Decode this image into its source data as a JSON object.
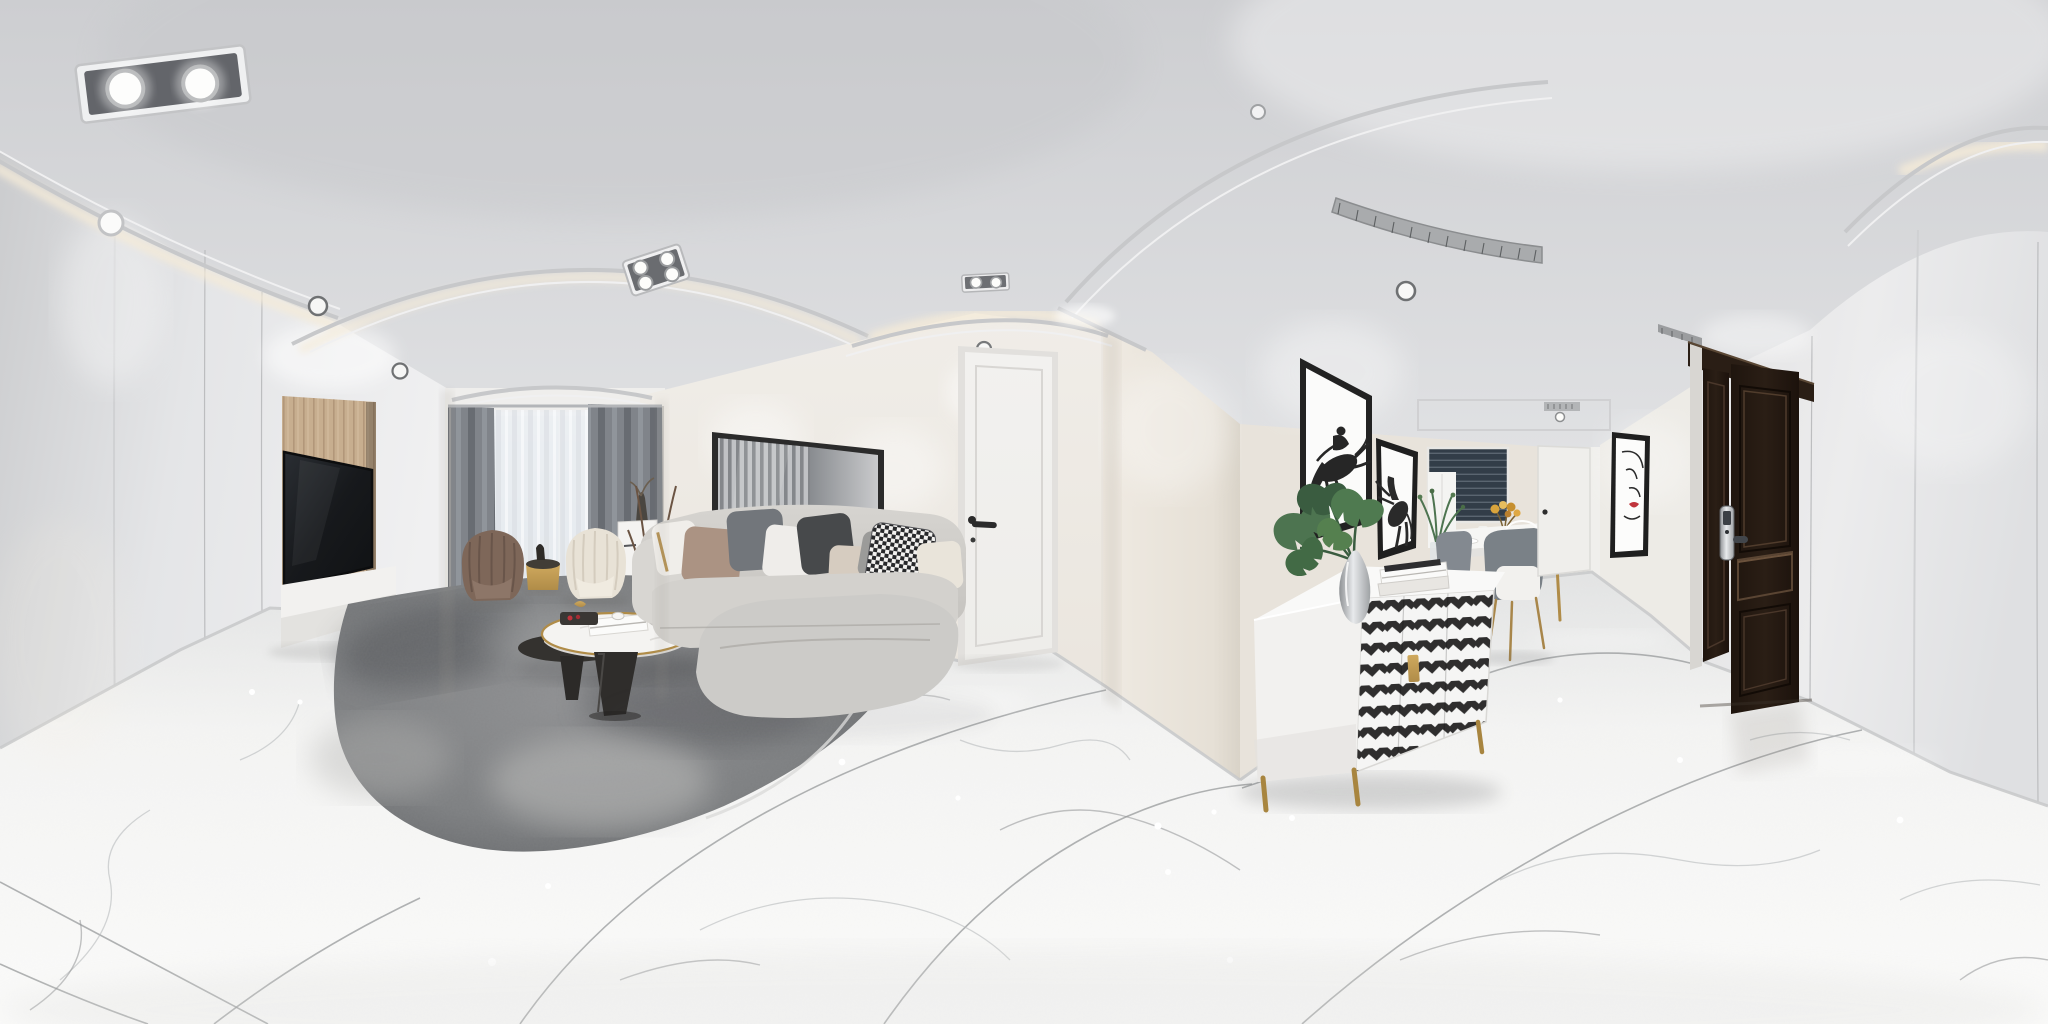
{
  "meta": {
    "kind": "photograph",
    "projection": "equirectangular-360-panorama",
    "subject": "modern minimalist white apartment interior: living room, entry hallway and dining nook",
    "width_px": 2048,
    "height_px": 1024,
    "no_visible_text": true
  },
  "palette": {
    "ceiling_top": "#cdced1",
    "ceiling_bottom": "#e2e3e5",
    "led_warm": "#f5ebd8",
    "wall_white": "#eceae7",
    "wall_bright": "#f2f1ee",
    "wall_warm": "#e9e4dc",
    "wall_left_light": "#e4e5e7",
    "wall_left_dark": "#cbccce",
    "floor_light": "#f4f4f3",
    "floor_shade": "#e3e4e4",
    "rug_dark": "#5d5f62",
    "rug_mid": "#8f9092",
    "sofa_light": "#d6d4d0",
    "sofa_mid": "#c5c3bf",
    "sofa_dark": "#a5a29d",
    "pillow_taupe": "#ab9383",
    "pillow_charcoal": "#47494b",
    "pillow_velvet": "#72767b",
    "pillow_beige": "#d6ccc0",
    "pillow_white": "#f0eeea",
    "curtain_gray": "#80848a",
    "sheer_white": "#edeff1",
    "window_sky": "#e6eef5",
    "tv_wood": "#c7ae8f",
    "tv_screen": "#17191c",
    "interior_door": "#eeedea",
    "entry_door": "#2a1e15",
    "gold_accent": "#b08c48",
    "chevron_dark": "#2f2e2e",
    "art_black": "#222222",
    "art_red": "#c0343c",
    "plant_green": "#4d7450",
    "plant_green_dark": "#3a5c40",
    "chair_brown": "#7e6759",
    "chair_cream": "#e8e2d6",
    "dining_chair_gray": "#7a8187",
    "blinds_dark": "#323d48"
  },
  "scene": {
    "ceiling": {
      "objects": [
        {
          "id": "twin-spot-fixture-left",
          "label": "recessed twin square spotlight, top left"
        },
        {
          "id": "quad-spot-fixture",
          "label": "recessed 4-lamp grille spotlight over living room"
        },
        {
          "id": "twin-spot-fixture-door",
          "label": "small twin spotlight above interior door"
        },
        {
          "id": "cove-led-arcs",
          "label": "curved plaster coves with warm LED strips"
        },
        {
          "id": "ac-vent",
          "label": "linear air-conditioning grille, hallway ceiling"
        },
        {
          "id": "downlights",
          "label": "round recessed downlights"
        }
      ]
    },
    "living_room": {
      "objects": [
        {
          "id": "tv",
          "label": "wall-mounted flat TV on light wood feature panel"
        },
        {
          "id": "tv-console",
          "label": "white floating media console"
        },
        {
          "id": "window",
          "label": "bay window, gray blackout curtains and white sheers"
        },
        {
          "id": "armchair-brown",
          "label": "brown channel-tufted shell armchair"
        },
        {
          "id": "armchair-cream",
          "label": "cream channel-tufted shell armchair"
        },
        {
          "id": "side-table-gold",
          "label": "small gold drum side table"
        },
        {
          "id": "slat-panel-art",
          "label": "large dark-framed slatted wall panel behind sofa"
        },
        {
          "id": "sofa",
          "label": "light gray sectional sofa with chaise and mixed pillows"
        },
        {
          "id": "pillows",
          "label": "white / taupe / charcoal / beige / houndstooth cushions"
        },
        {
          "id": "coffee-table",
          "label": "round marble-top coffee table, gold rim, black cone base"
        },
        {
          "id": "coffee-table-black",
          "label": "lower black companion table"
        },
        {
          "id": "rug",
          "label": "distressed gray abstract area rug"
        },
        {
          "id": "interior-door",
          "label": "white interior door with black lever handle"
        },
        {
          "id": "small-cabinet",
          "label": "small white cabinet beside window"
        }
      ]
    },
    "hallway": {
      "objects": [
        {
          "id": "horse-art-1",
          "label": "black framed print, jockey on jumping horse"
        },
        {
          "id": "horse-art-2",
          "label": "black framed print, rearing horse"
        },
        {
          "id": "monstera",
          "label": "monstera leaves in silver teardrop vase"
        },
        {
          "id": "books",
          "label": "stacked white coffee-table books"
        },
        {
          "id": "sideboard",
          "label": "white sideboard with black-and-white chevron doors, gold handles and legs"
        },
        {
          "id": "dining-table",
          "label": "white dining table with gold legs"
        },
        {
          "id": "dining-chairs",
          "label": "gray upholstered dining chairs with gold legs"
        },
        {
          "id": "wire-chair",
          "label": "white wireframe chair"
        },
        {
          "id": "flowers",
          "label": "amber-yellow flower arrangement"
        },
        {
          "id": "greenery",
          "label": "green sprigs in glass vase"
        },
        {
          "id": "dining-window",
          "label": "window with dark venetian blinds"
        },
        {
          "id": "far-door",
          "label": "white door at end of hallway"
        },
        {
          "id": "abstract-art",
          "label": "minimal line-art face print with red lips"
        },
        {
          "id": "entry-door",
          "label": "dark walnut double entry door with silver smart lock"
        }
      ]
    },
    "floor": {
      "material": "white marble tile with gray veining, curved grout lines from panorama projection",
      "highlights": "small specular reflections from downlights"
    }
  }
}
